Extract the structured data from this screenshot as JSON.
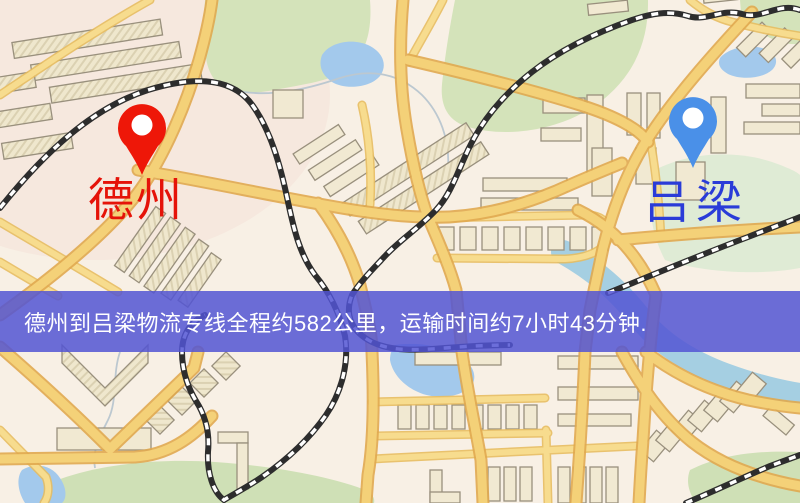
{
  "view": {
    "type": "map-route-overview",
    "base_color": "#f8f0e5",
    "road_color": "#f4d178",
    "park_color": "#d4e3ba",
    "water_color": "#a3c9ec"
  },
  "map": {
    "origin_marker": {
      "label": "德州",
      "pin_color": "#ee1708",
      "label_color": "#e51309"
    },
    "destination_marker": {
      "label": "吕梁",
      "pin_color": "#4a90e8",
      "label_color": "#2a3cd8"
    }
  },
  "banner": {
    "text": "德州到吕梁物流专线全程约582公里，运输时间约7小时43分钟.",
    "background": "#5255d3",
    "text_color": "#ffffff",
    "route": {
      "origin": "德州",
      "destination": "吕梁",
      "service": "物流专线",
      "distance": "约582公里",
      "duration": "约7小时43分钟"
    }
  }
}
